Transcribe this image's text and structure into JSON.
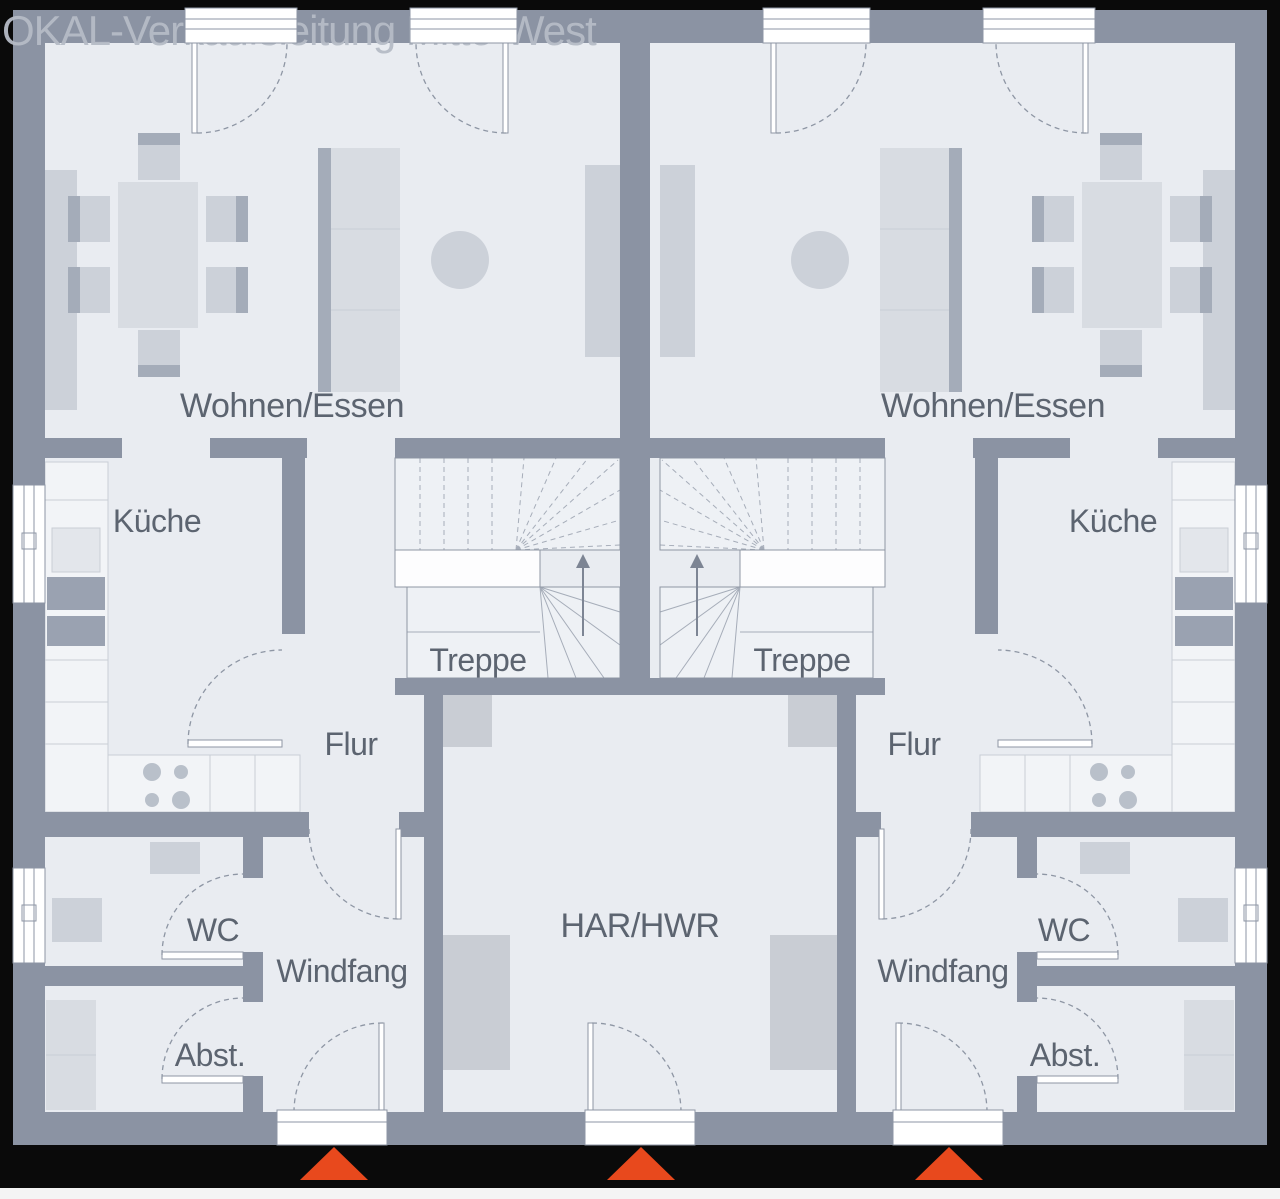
{
  "watermark": "OKAL-Verkaufsleitung Mitte-West",
  "colors": {
    "frame": "#0a0a0a",
    "floor": "#e9ecf1",
    "wall": "#8b93a3",
    "stair": "#eef1f5",
    "landing": "#fdfdfe",
    "furn": "#ccd1d9",
    "furnlight": "#d8dce2",
    "furndark": "#a4acb9",
    "counter": "#f2f4f7",
    "appliance": "#9aa2b1",
    "harbox": "#c9cdd4",
    "window": "#ffffff",
    "line": "#8e96a4",
    "label": "#5c6470",
    "watermark": "#b6bcc6",
    "accent": "#e8491d",
    "bottom": "#f4f4f4"
  },
  "rooms": {
    "left_unit": {
      "living": "Wohnen/Essen",
      "kitchen": "Küche",
      "stairs": "Treppe",
      "hallway": "Flur",
      "wc": "WC",
      "vestibule": "Windfang",
      "storage": "Abst."
    },
    "right_unit": {
      "living": "Wohnen/Essen",
      "kitchen": "Küche",
      "stairs": "Treppe",
      "hallway": "Flur",
      "wc": "WC",
      "vestibule": "Windfang",
      "storage": "Abst."
    },
    "shared": {
      "utility": "HAR/HWR"
    }
  },
  "entrance_markers": {
    "count": 3,
    "color": "#e8491d"
  }
}
